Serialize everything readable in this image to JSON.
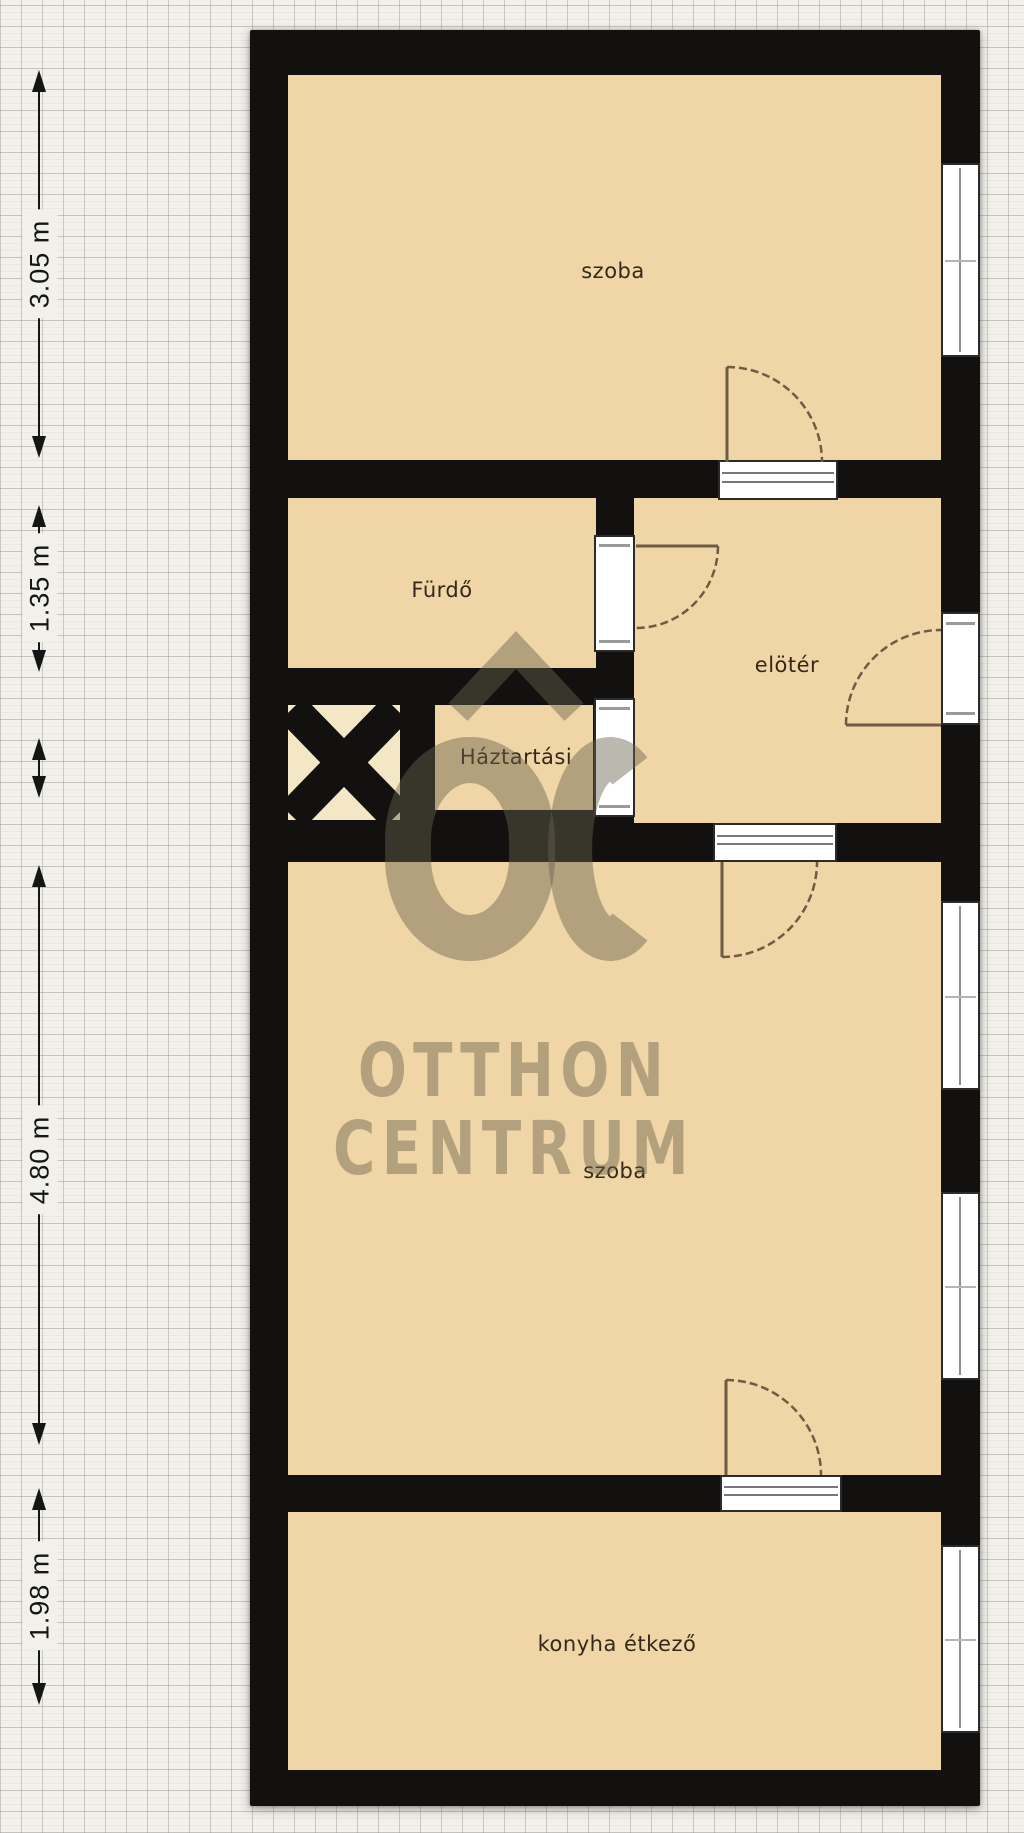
{
  "page": {
    "type": "floor-plan-scan"
  },
  "plan": {
    "rooms": [
      {
        "id": "szoba-top",
        "label": "szoba"
      },
      {
        "id": "furdo",
        "label": "Fürdő"
      },
      {
        "id": "eloter",
        "label": "elötér"
      },
      {
        "id": "haztartasi",
        "label": "Háztartási"
      },
      {
        "id": "szoba-middle",
        "label": "szoba"
      },
      {
        "id": "konyha-etkezo",
        "label": "konyha étkező"
      }
    ]
  },
  "dimensions": {
    "items": [
      {
        "label": "3.05 m"
      },
      {
        "label": "1.35 m"
      },
      {
        "label": "4.80 m"
      },
      {
        "label": "1.98 m"
      }
    ]
  },
  "watermark": {
    "brand_line1": "OTTHON",
    "brand_line2": "CENTRUM",
    "logo": "otthon-centrum-house-oc-logo"
  },
  "colors": {
    "paper": "#f1f0eb",
    "grid": "#d8d7d1",
    "wall": "#121110",
    "room": "#f0d5a6",
    "xbox": "#f4e7c6",
    "opening": "#ffffff",
    "door": "#6e5d44",
    "label": "#33291a",
    "dim": "#151515",
    "watermark": "rgba(104,98,78,0.45)"
  }
}
